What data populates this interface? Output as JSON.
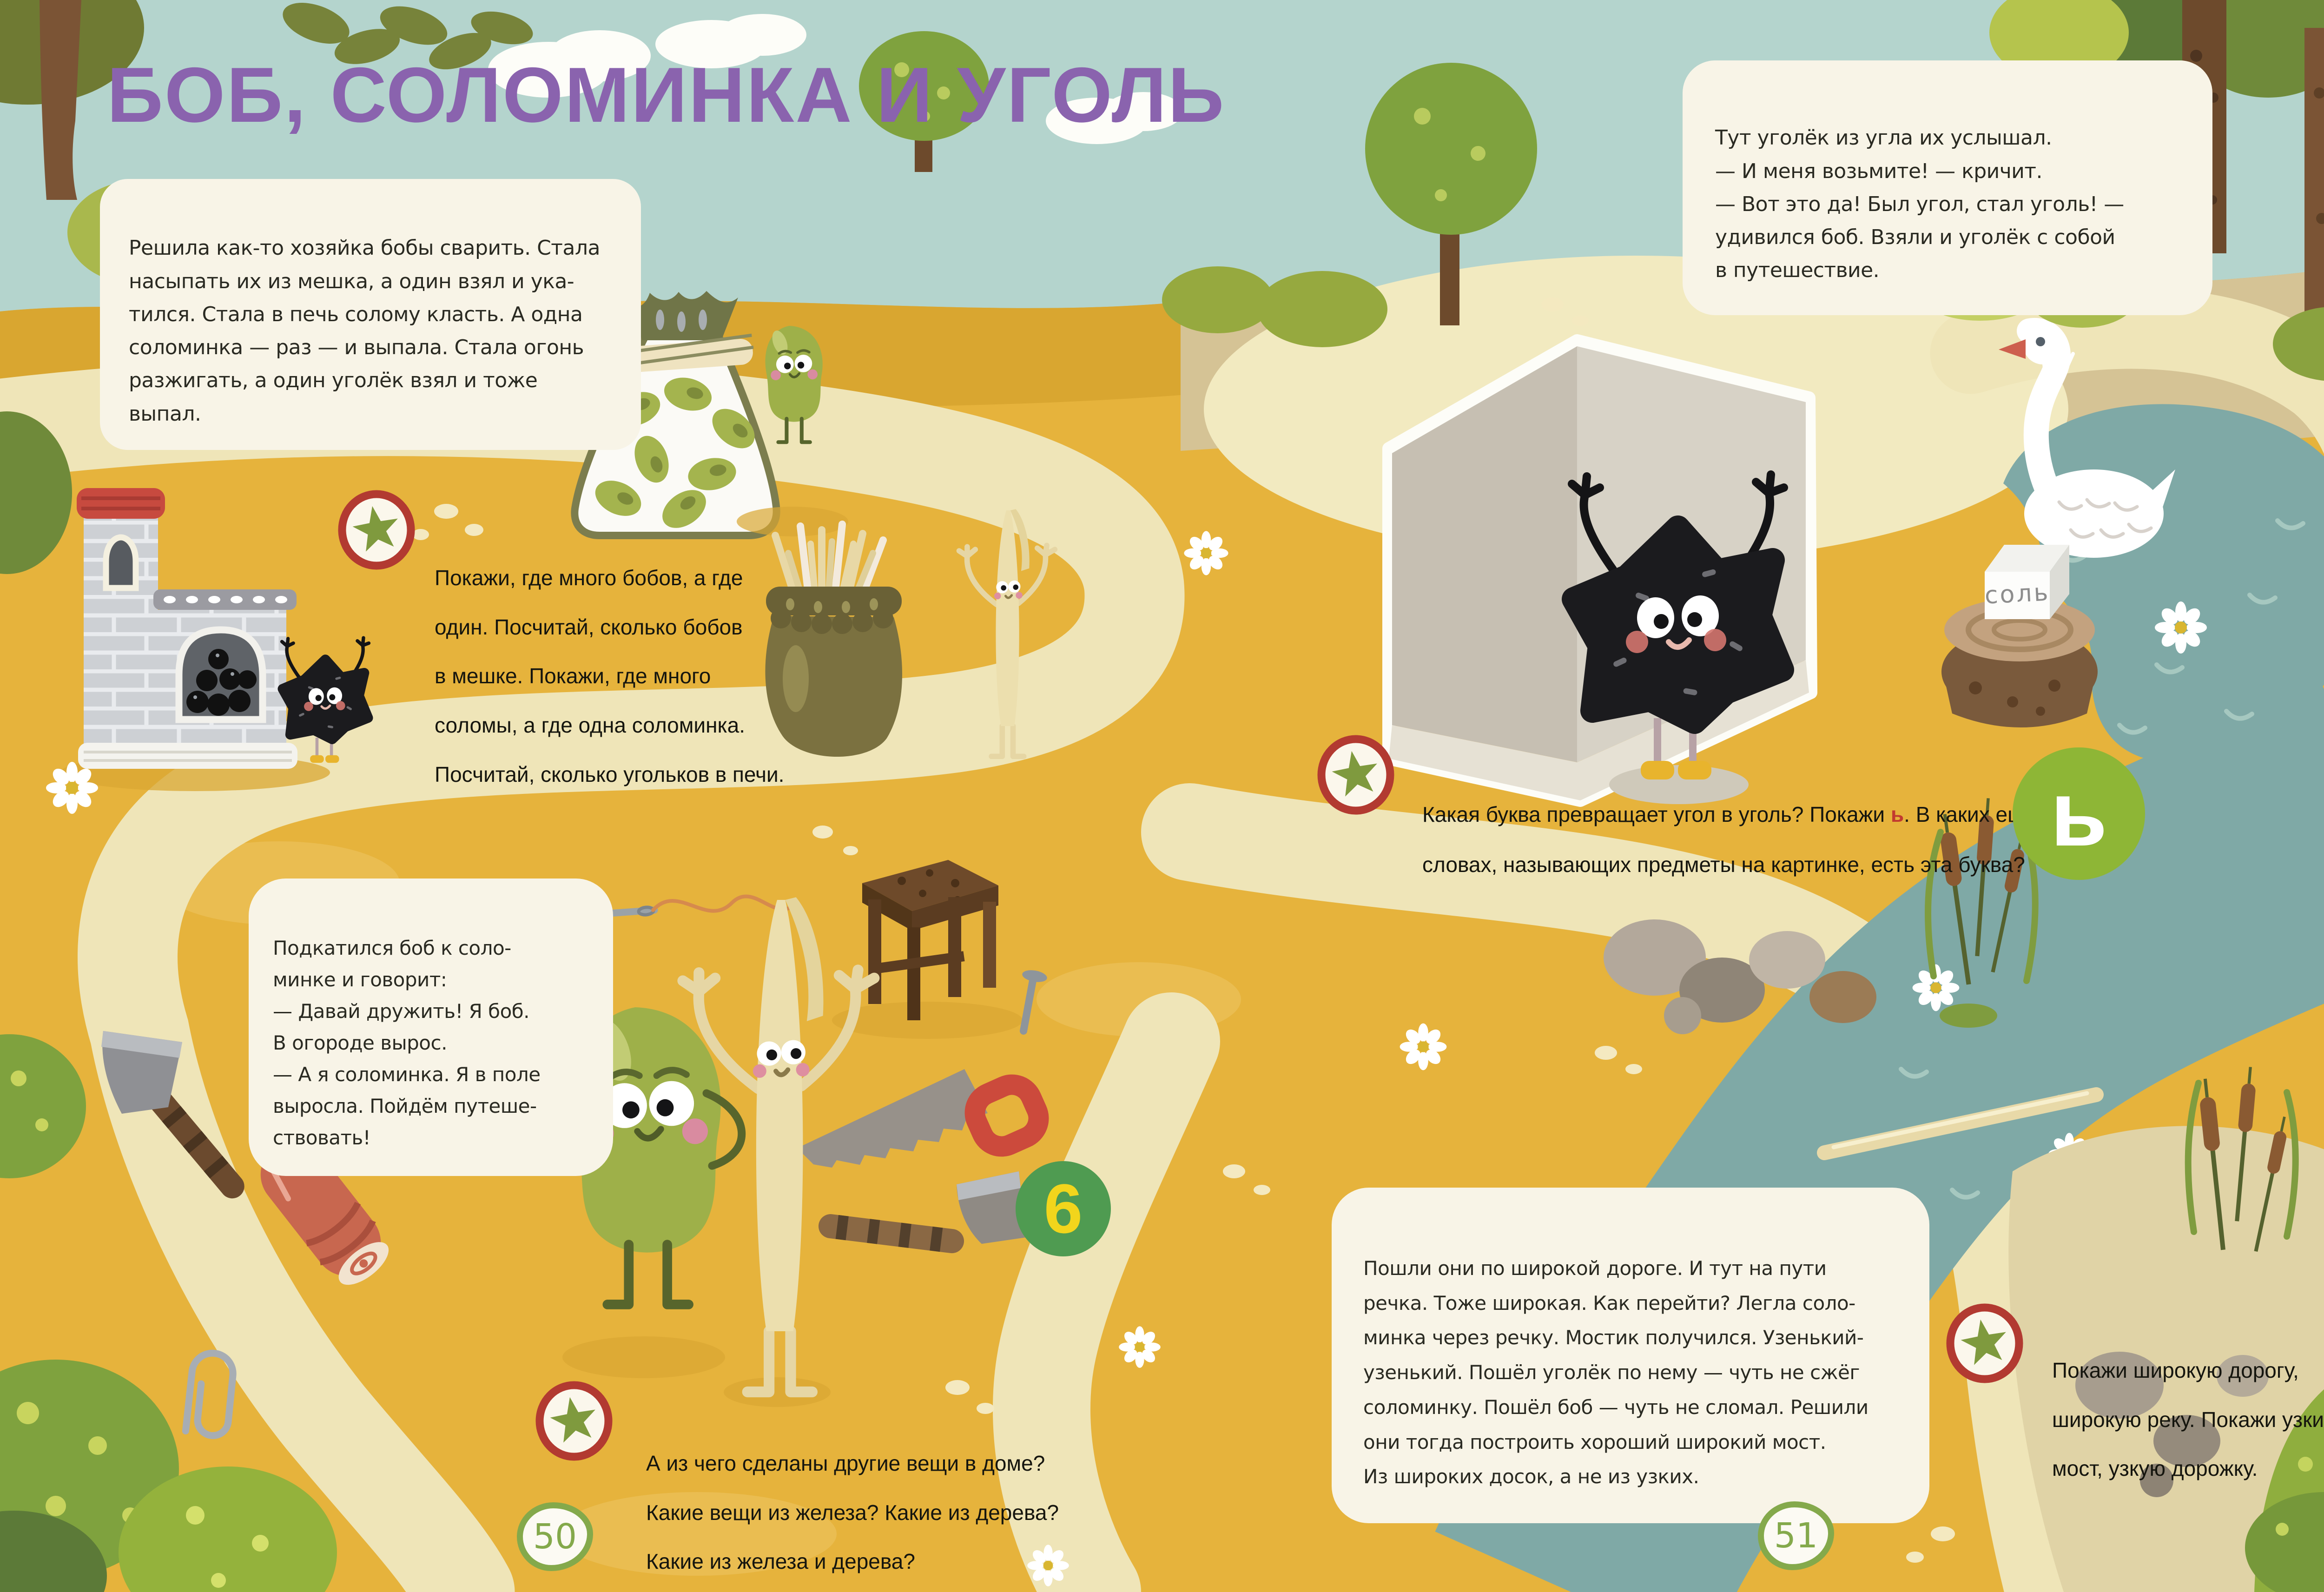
{
  "title": "БОБ, СОЛОМИНКА И УГОЛЬ",
  "story": {
    "intro": "Решила как-то хозяйка бобы сварить. Стала\nнасыпать их из мешка, а один взял и ука-\nтился. Стала в печь солому класть. А одна\nсоломинка — раз — и выпала. Стала огонь\nразжигать, а один уголёк взял и тоже выпал.",
    "dialog": "Подкатился боб к соло-\nминке и говорит:\n— Давай дружить! Я боб.\nВ огороде вырос.\n— А я соломинка. Я в поле\nвыросла. Пойдём путеше-\nствовать!",
    "coal": "Тут уголёк из угла их услышал.\n— И меня возьмите! — кричит.\n— Вот это да! Был угол, стал уголь! —\nудивился боб. Взяли и уголёк с собой\nв путешествие.",
    "river": "Пошли они по широкой дороге. И тут на пути\nречка. Тоже широкая. Как перейти? Легла соло-\nминка через речку. Мостик получился. Узенький-\nузенький. Пошёл уголёк по нему — чуть не сжёг\nсоломинку. Пошёл боб — чуть не сломал. Решили\nони тогда построить хороший широкий мост.\nИз широких досок, а не из узких."
  },
  "tasks": {
    "count": "Покажи, где много бобов, а где\nодин. Посчитай, сколько бобов\nв мешке. Покажи, где много\nсоломы, а где одна соломинка.\nПосчитай, сколько угольков в печи.",
    "materials": "А из чего сделаны другие вещи в доме?\nКакие вещи из железа? Какие из дерева?\nКакие из железа и дерева?",
    "letter_before": "Какая буква превращает угол в уголь? Покажи ",
    "letter_char": "ь",
    "letter_after": ". В каких ещё\nсловах, называющих предметы на картинке, есть эта буква?",
    "wide_narrow": "Покажи широкую дорогу,\nширокую реку. Покажи узкий\nмост, узкую дорожку."
  },
  "labels": {
    "salt_cube": "соль",
    "soft_sign_circle": "ь",
    "scene_number": "6",
    "page_left": "50",
    "page_right": "51"
  },
  "colors": {
    "title_purple": "#8a63ae",
    "letter_red": "#c23a2f",
    "field_yellow": "#e6b33c",
    "sky_teal": "#b4d4cd",
    "road_cream": "#efe5b8",
    "water_teal": "#7fa9a6",
    "circle_green_light": "#8eb636",
    "circle_green_dark": "#4f9b51",
    "page_number_green": "#84a94b"
  }
}
